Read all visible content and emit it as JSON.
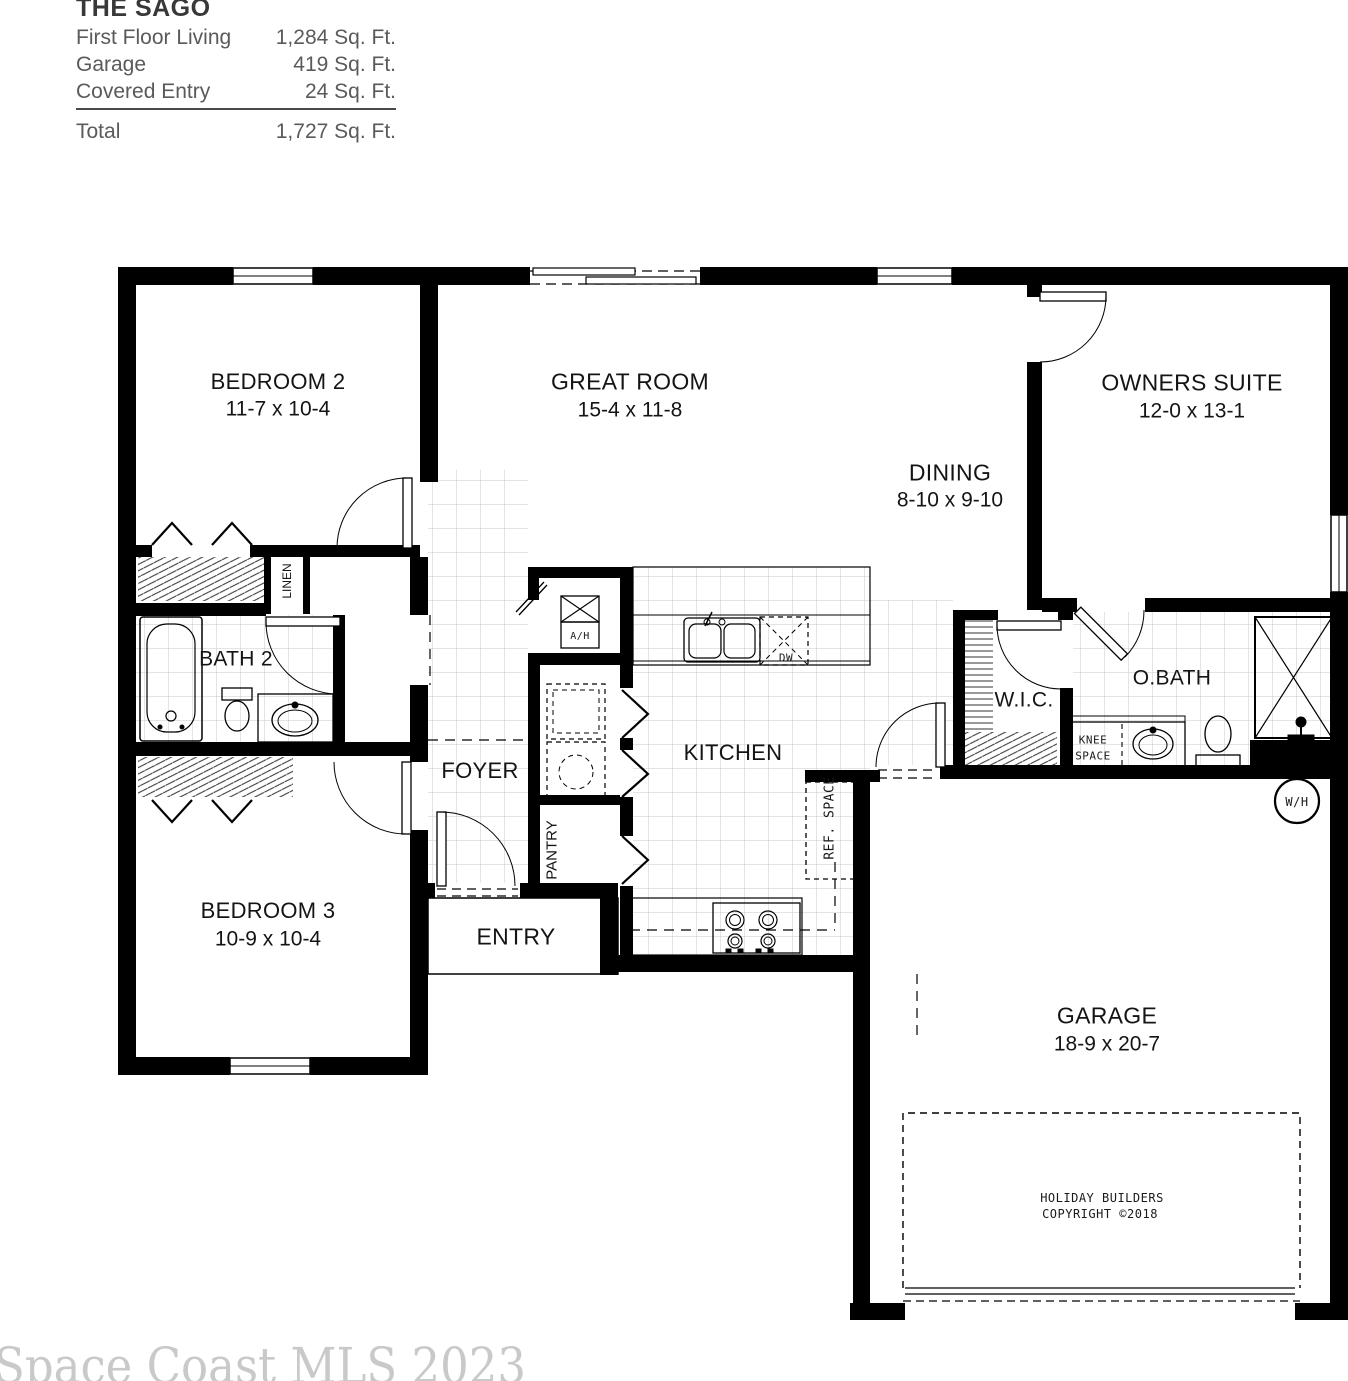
{
  "header": {
    "plan_name": "THE SAGO",
    "rows": [
      {
        "label": "First Floor Living",
        "value": "1,284 Sq. Ft."
      },
      {
        "label": "Garage",
        "value": "419 Sq. Ft."
      },
      {
        "label": "Covered Entry",
        "value": "24 Sq. Ft."
      }
    ],
    "total_label": "Total",
    "total_value": "1,727 Sq. Ft."
  },
  "rooms": {
    "bedroom2": {
      "name": "BEDROOM 2",
      "dims": "11-7 x 10-4"
    },
    "great_room": {
      "name": "GREAT ROOM",
      "dims": "15-4 x 11-8"
    },
    "owners_suite": {
      "name": "OWNERS SUITE",
      "dims": "12-0 x 13-1"
    },
    "dining": {
      "name": "DINING",
      "dims": "8-10 x 9-10"
    },
    "bedroom3": {
      "name": "BEDROOM 3",
      "dims": "10-9 x 10-4"
    },
    "garage": {
      "name": "GARAGE",
      "dims": "18-9 x 20-7"
    },
    "bath2": {
      "name": "BATH 2"
    },
    "foyer": {
      "name": "FOYER"
    },
    "kitchen": {
      "name": "KITCHEN"
    },
    "entry": {
      "name": "ENTRY"
    },
    "wic": {
      "name": "W.I.C."
    },
    "obath": {
      "name": "O.BATH"
    }
  },
  "closets": {
    "linen": "LINEN",
    "pantry": "PANTRY"
  },
  "equipment": {
    "air_handler": "A/H",
    "dishwasher": "DW",
    "ref_space": "REF. SPACE",
    "knee_space_line1": "KNEE",
    "knee_space_line2": "SPACE",
    "water_heater": "W/H"
  },
  "branding": {
    "line1": "HOLIDAY BUILDERS",
    "line2": "COPYRIGHT ©2018"
  },
  "watermark": "Space Coast MLS 2023",
  "colors": {
    "wall": "#000000",
    "tile_grid": "#c8c8c8",
    "hatch": "#333333",
    "text": "#141414",
    "summary_text": "#5a5a5a",
    "watermark": "#c9c9c9"
  }
}
